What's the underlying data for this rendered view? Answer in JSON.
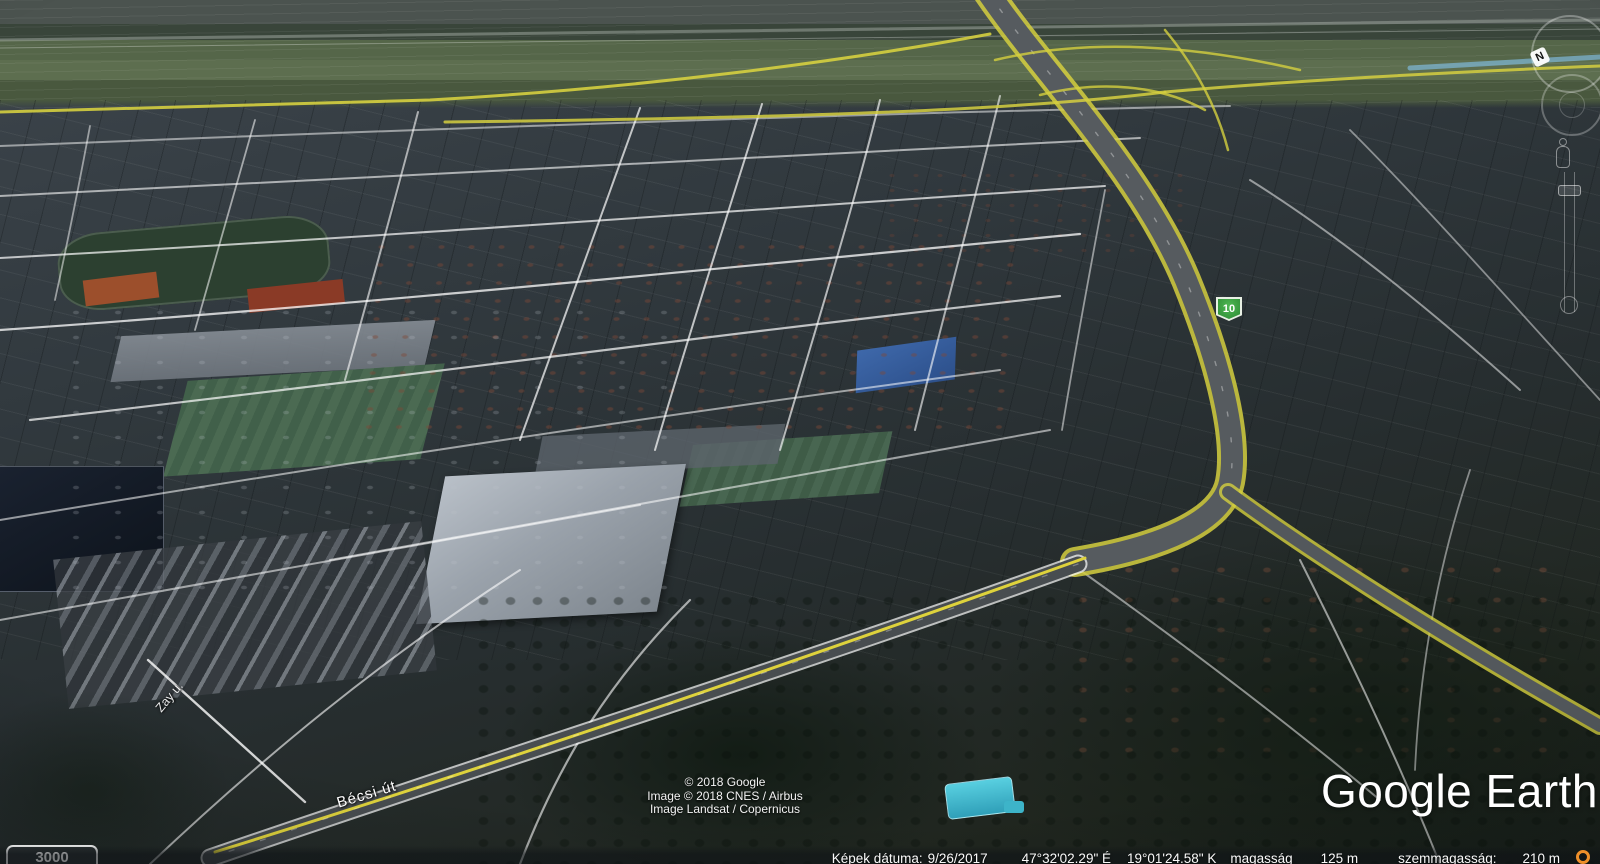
{
  "map": {
    "street_labels": [
      {
        "text": "Bécsi út"
      },
      {
        "text": "Zay u."
      }
    ],
    "road_shield": {
      "number": "10"
    },
    "scale_badge": "3000"
  },
  "attribution": {
    "lines": [
      "© 2018 Google",
      "Image © 2018 CNES / Airbus",
      "Image Landsat / Copernicus"
    ]
  },
  "logo": {
    "text": "Google Earth"
  },
  "status_bar": {
    "imagery_date_label": "Képek dátuma:",
    "imagery_date": "9/26/2017",
    "latitude": "47°32'02.29\" É",
    "longitude": "19°01'24.58\" K",
    "elevation_label": "magasság",
    "elevation": "125 m",
    "eye_altitude_label": "szemmagasság:",
    "eye_altitude": "210 m"
  },
  "navigation": {
    "compass_north_label": "N"
  },
  "icons": {
    "streaming_progress": "orange-ring",
    "pegman": "street-view-figure"
  },
  "colors": {
    "road_yellow": "#d5cf3f",
    "shield_green": "#2c8a33",
    "pool_blue": "#49c4da",
    "streaming_orange": "#ee8f2a",
    "logo_white": "#ffffff"
  }
}
